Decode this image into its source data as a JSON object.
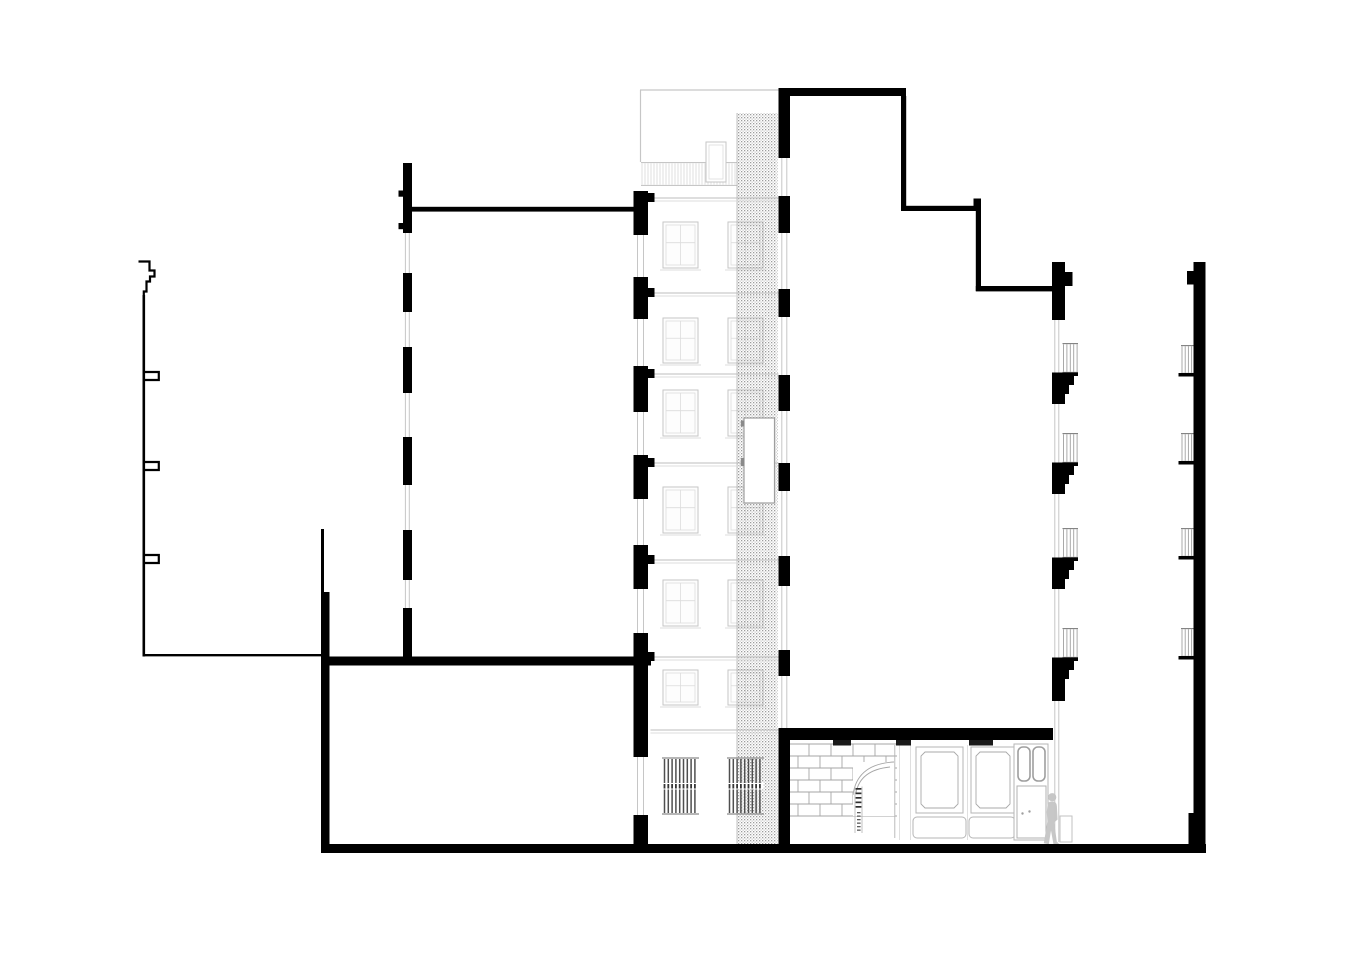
{
  "meta": {
    "label": "architectural cross-section drawing",
    "canvas_width": 1350,
    "canvas_height": 954
  },
  "colors": {
    "ink": "#000000",
    "white": "#ffffff",
    "faint": "#c6c6c6",
    "faint_light": "#dcdcdc",
    "faint_dark": "#9e9e9e",
    "mid": "#b3b3b3",
    "hatch_a": "#9c9c9c",
    "hatch_b": "#cccccc",
    "grille": "#4f4f4f",
    "grille_band": "#353535",
    "brick": "#a6a6a6",
    "person": "#c7c7c7"
  },
  "section": {
    "ground": {
      "slab": [
        321,
        844,
        885,
        9
      ],
      "left_line": [
        143,
        655.2,
        186,
        2.4
      ]
    },
    "basement": {
      "wall_thin": [
        321,
        529,
        3,
        64
      ],
      "wall": [
        321,
        592,
        8.5,
        256
      ],
      "floor": [
        329,
        656.5,
        322,
        9
      ]
    },
    "profile": {
      "cap": "M138.5,261.5 H149.5 V270.5 H154.5 V276.5 H150 V281.5 H146.5 V291.5 H143.8 V297",
      "line_x": 143.8,
      "line_y1": 295,
      "line_y2": 656.5,
      "ledges_y": [
        372,
        462,
        555
      ],
      "ledge_w": 14,
      "ledge_h": 8
    },
    "left_wall": {
      "x": 403,
      "w": 9,
      "segments": [
        [
          163,
          233
        ],
        [
          273,
          312
        ],
        [
          347,
          393
        ],
        [
          437,
          485
        ],
        [
          530,
          580
        ],
        [
          608,
          657
        ]
      ],
      "nubs_y": [
        190.5,
        223
      ],
      "glaze_x": [
        405.4,
        409.3
      ],
      "glaze_y": [
        163,
        657
      ]
    },
    "beam": [
      412,
      206.8,
      225,
      4.8
    ],
    "facade_wall": {
      "x": 633.5,
      "w": 14.5,
      "segments": [
        [
          191,
          235
        ],
        [
          277,
          319
        ],
        [
          366,
          412
        ],
        [
          455,
          499
        ],
        [
          545,
          589
        ],
        [
          633,
          757
        ],
        [
          815,
          853
        ]
      ],
      "bump_y": [
        193,
        288,
        369,
        458,
        555,
        652
      ],
      "glaze_x": [
        637.5,
        643.5
      ],
      "glaze_y": [
        191,
        853
      ]
    },
    "facade": {
      "roof_y": 90,
      "left_x": 640.5,
      "right_x": 778.5,
      "floors": [
        198,
        293,
        374,
        463,
        560,
        657,
        730
      ],
      "floor_x1": 650.5,
      "floor_x2": 778.5,
      "win_x": [
        663,
        728
      ],
      "win_w": 35,
      "win_rows": [
        [
          222,
          46
        ],
        [
          318,
          45
        ],
        [
          390,
          46
        ],
        [
          487,
          46
        ],
        [
          580,
          46
        ],
        [
          670,
          35
        ]
      ],
      "railing": [
        641,
        162,
        96,
        24
      ],
      "chimney": [
        706,
        142,
        20,
        40
      ],
      "grilles": {
        "y": 758,
        "h": 56,
        "xs": [
          663,
          728
        ],
        "w": 35,
        "band_dy": 25,
        "band_h": 6.5
      }
    },
    "hatch": {
      "rect": [
        737,
        113,
        40.5,
        731
      ],
      "elevator": [
        744,
        418,
        30.5,
        85
      ],
      "ticks": [
        [
          740.8,
          420.5,
          3.4,
          6
        ],
        [
          740.8,
          458,
          3.4,
          8
        ]
      ]
    },
    "party_wall": {
      "x": 778.5,
      "w": 11.5,
      "segments": [
        [
          88,
          158
        ],
        [
          196,
          233
        ],
        [
          289,
          317
        ],
        [
          375,
          411
        ],
        [
          463,
          491
        ],
        [
          556,
          586
        ],
        [
          650,
          676
        ],
        [
          740,
          848
        ]
      ],
      "glaze_x": [
        781.8,
        786.8
      ],
      "glaze_y": [
        155,
        728
      ],
      "roof_bar": [
        778.5,
        88,
        127.5,
        8
      ],
      "beam": [
        778.5,
        728,
        274.5,
        12
      ],
      "beam_tabs": [
        [
          833,
          18
        ],
        [
          896,
          15
        ],
        [
          969,
          24
        ]
      ],
      "tab_h": 5.5
    },
    "roof_steps": {
      "bars": [
        [
          901,
          96,
          5.2,
          114.8
        ],
        [
          901,
          205.8,
          80,
          5.2
        ],
        [
          973.5,
          198.5,
          7.5,
          7.5
        ],
        [
          975.8,
          206,
          5.2,
          85
        ],
        [
          975.8,
          286,
          77.2,
          5.4
        ]
      ]
    },
    "wall_a": {
      "x": 1052,
      "w": 13,
      "top_block": [
        1052,
        262,
        13,
        58
      ],
      "top_bump": [
        1065,
        272,
        7.5,
        14
      ],
      "glaze_x": [
        1054.8,
        1058.8
      ],
      "glaze_y": [
        262,
        842
      ],
      "balcony_y": [
        343,
        433,
        528,
        628
      ],
      "railing": {
        "x": 1062.5,
        "w": 15.5,
        "h": 30,
        "step": 3.4
      },
      "slab": {
        "x": 1052,
        "w": 26,
        "h": 3.5
      },
      "cornice_y": [
        376,
        466,
        561,
        661
      ],
      "cornice_steps": [
        [
          0,
          22,
          9
        ],
        [
          9,
          17,
          9
        ],
        [
          18,
          13,
          10
        ]
      ],
      "last_extra": [
        28,
        13,
        12
      ]
    },
    "wall_b": {
      "x": 1193.5,
      "w": 12,
      "y1": 262,
      "y2": 844,
      "bump": [
        1187,
        271,
        6.5,
        13.5
      ],
      "base": [
        1188.5,
        813,
        5,
        31
      ],
      "balcony_y": [
        345,
        433,
        528,
        628
      ],
      "railing": {
        "x": 1181,
        "w": 12.5,
        "h": 29,
        "step": 3.2
      },
      "slab": {
        "x": 1178.5,
        "w": 15.5,
        "h": 3.5
      }
    },
    "storefront": {
      "brick": {
        "x": 787,
        "y": 744,
        "w": 110,
        "h": 72,
        "row_h": 12,
        "brick_w": 22
      },
      "opening": [
        853,
        762,
        42,
        54
      ],
      "arch": [
        "M853,795 Q857,764 894,762",
        "M856,793 Q860,770 890,767"
      ],
      "door_line": [
        894.8,
        745,
        838
      ],
      "stair": {
        "x1": 855,
        "x2": 862,
        "y1": 786.5,
        "y2": 833,
        "treads": 5,
        "dashes": 6
      },
      "panels": [
        [
          916,
          747,
          47,
          66
        ],
        [
          971,
          747,
          44,
          66
        ]
      ],
      "panel_inset": 5,
      "chamfer": 4,
      "lower_panels": [
        [
          913,
          817,
          53,
          21
        ],
        [
          969,
          817,
          46,
          21
        ]
      ],
      "separators_x": [
        899.5,
        910.5,
        967.5
      ],
      "door": {
        "frame": [
          1014,
          744,
          34,
          96
        ],
        "panes": [
          [
            1018,
            747,
            12,
            34
          ],
          [
            1033,
            747,
            12,
            34
          ]
        ],
        "panel": [
          1017,
          786,
          29,
          52
        ],
        "handles": [
          [
            1022.5,
            813.5
          ],
          [
            1029.5,
            811.5
          ]
        ]
      },
      "step_block": [
        1060,
        816,
        12,
        26
      ]
    },
    "person": {
      "head": [
        1052.2,
        797.2,
        4.1
      ],
      "body": "M1047.4,806.2 Q1047.2,801.6 1052,801.4 Q1056.8,801.4 1056.9,806.2 L1057.6,819.5 L1054.2,822.5 L1056.8,841.5 L1059.8,844.8 L1053.6,845 L1051,830.5 L1048.8,844.2 L1043.8,843.2 L1047.4,821.5 L1046.8,812 Z"
    }
  }
}
